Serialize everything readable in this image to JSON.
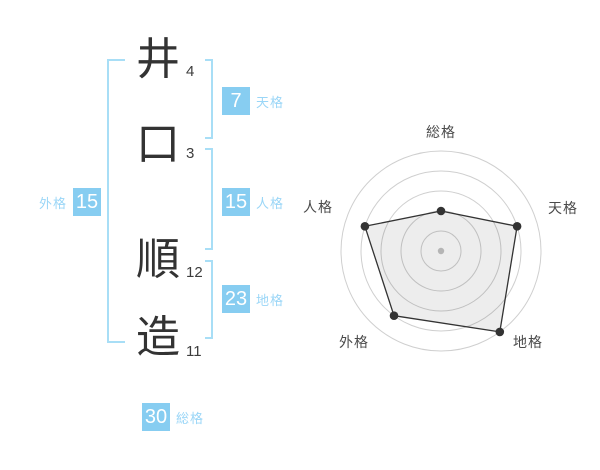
{
  "name_panel": {
    "characters": [
      {
        "char": "井",
        "strokes": "4"
      },
      {
        "char": "口",
        "strokes": "3"
      },
      {
        "char": "順",
        "strokes": "12"
      },
      {
        "char": "造",
        "strokes": "11"
      }
    ],
    "badges": {
      "tenkaku": {
        "value": "7",
        "label": "天格"
      },
      "jinkaku": {
        "value": "15",
        "label": "人格"
      },
      "chikaku": {
        "value": "23",
        "label": "地格"
      },
      "gaikaku": {
        "value": "15",
        "label": "外格"
      },
      "soukaku": {
        "value": "30",
        "label": "総格"
      }
    },
    "colors": {
      "badge_bg": "#87cdf1",
      "badge_number": "#ffffff",
      "badge_label": "#9ad6f7",
      "bracket": "#a8def6",
      "kanji_text": "#333333",
      "stroke_count_text": "#3d3d3d"
    }
  },
  "chart_data": {
    "type": "radar",
    "axes": [
      "総格",
      "天格",
      "地格",
      "外格",
      "人格"
    ],
    "values": [
      2,
      4,
      5,
      4,
      4
    ],
    "max": 5,
    "rings": 5,
    "grid": true,
    "legend": false,
    "title": "",
    "colors": {
      "grid": "#cfcfcf",
      "polygon_stroke": "#333333",
      "polygon_fill": "rgba(0,0,0,0.07)",
      "point": "#333333",
      "center_dot": "#b5b5b5",
      "label": "#4a4a4a"
    },
    "layout": {
      "center": [
        150,
        135
      ],
      "max_radius": 100,
      "label_font_size": 14,
      "labels": [
        {
          "text": "総格",
          "x": 150,
          "y": 16,
          "anchor": "middle"
        },
        {
          "text": "天格",
          "x": 257,
          "y": 92,
          "anchor": "start"
        },
        {
          "text": "地格",
          "x": 222,
          "y": 226,
          "anchor": "start"
        },
        {
          "text": "外格",
          "x": 78,
          "y": 226,
          "anchor": "end"
        },
        {
          "text": "人格",
          "x": 42,
          "y": 91,
          "anchor": "end"
        }
      ]
    }
  }
}
